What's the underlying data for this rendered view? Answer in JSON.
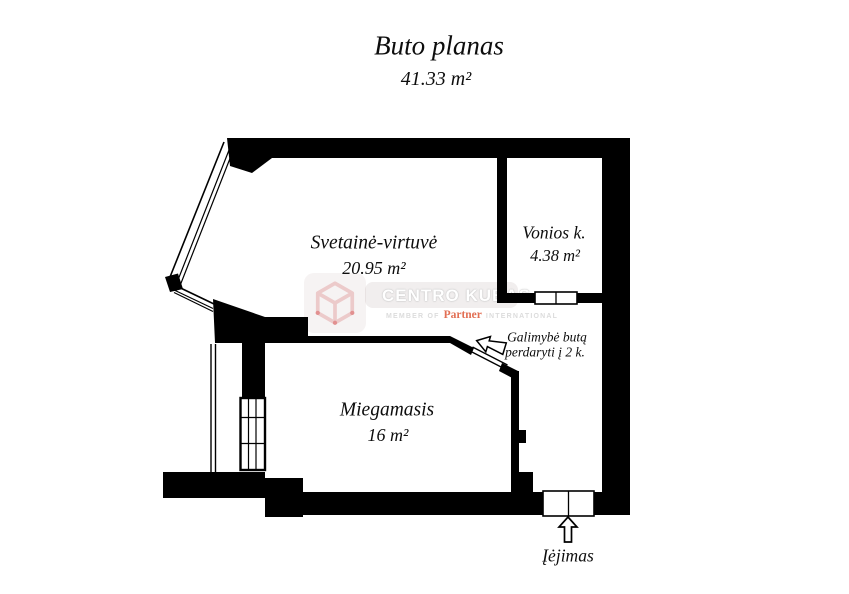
{
  "title": "Buto planas",
  "total_area": "41.33 m²",
  "rooms": [
    {
      "name": "Svetainė-virtuvė",
      "area": "20.95 m²"
    },
    {
      "name": "Vonios k.",
      "area": "4.38 m²"
    },
    {
      "name": "Miegamasis",
      "area": "16 m²"
    }
  ],
  "annotation": {
    "line1": "Galimybė butą",
    "line2": "perdaryti į 2 k."
  },
  "entrance": {
    "label": "Įėjimas"
  },
  "watermark": {
    "brand": "CENTRO KUBAS",
    "member_prefix": "MEMBER OF",
    "member_brand": "Partner",
    "member_suffix": "INTERNATIONAL"
  },
  "colors": {
    "wall": "#000000",
    "brand_red": "#e26f54",
    "watermark_gray": "#dcdcdc"
  }
}
